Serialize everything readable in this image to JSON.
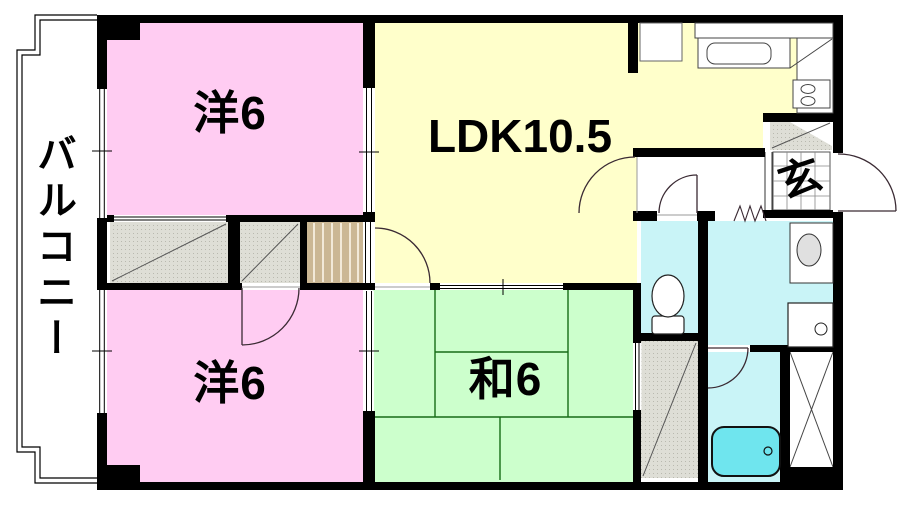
{
  "plan": {
    "title": "2LDK apartment floor plan",
    "rooms": {
      "western1": {
        "label": "洋6"
      },
      "western2": {
        "label": "洋6"
      },
      "ldk": {
        "label": "LDK10.5"
      },
      "japanese": {
        "label": "和6"
      },
      "balcony": {
        "label": "バルコニー"
      },
      "entrance": {
        "label": "玄"
      }
    },
    "colors": {
      "western": "#FFCCF2",
      "ldk": "#FFFFCB",
      "japanese": "#CCFFCC",
      "wet_room": "#C9F4F7",
      "bathtub": "#6FE5EE",
      "closet_gray": "#DEDED6",
      "closet_tan": "#CBB794",
      "wall": "#000000",
      "tatami_line": "#166B16"
    }
  }
}
